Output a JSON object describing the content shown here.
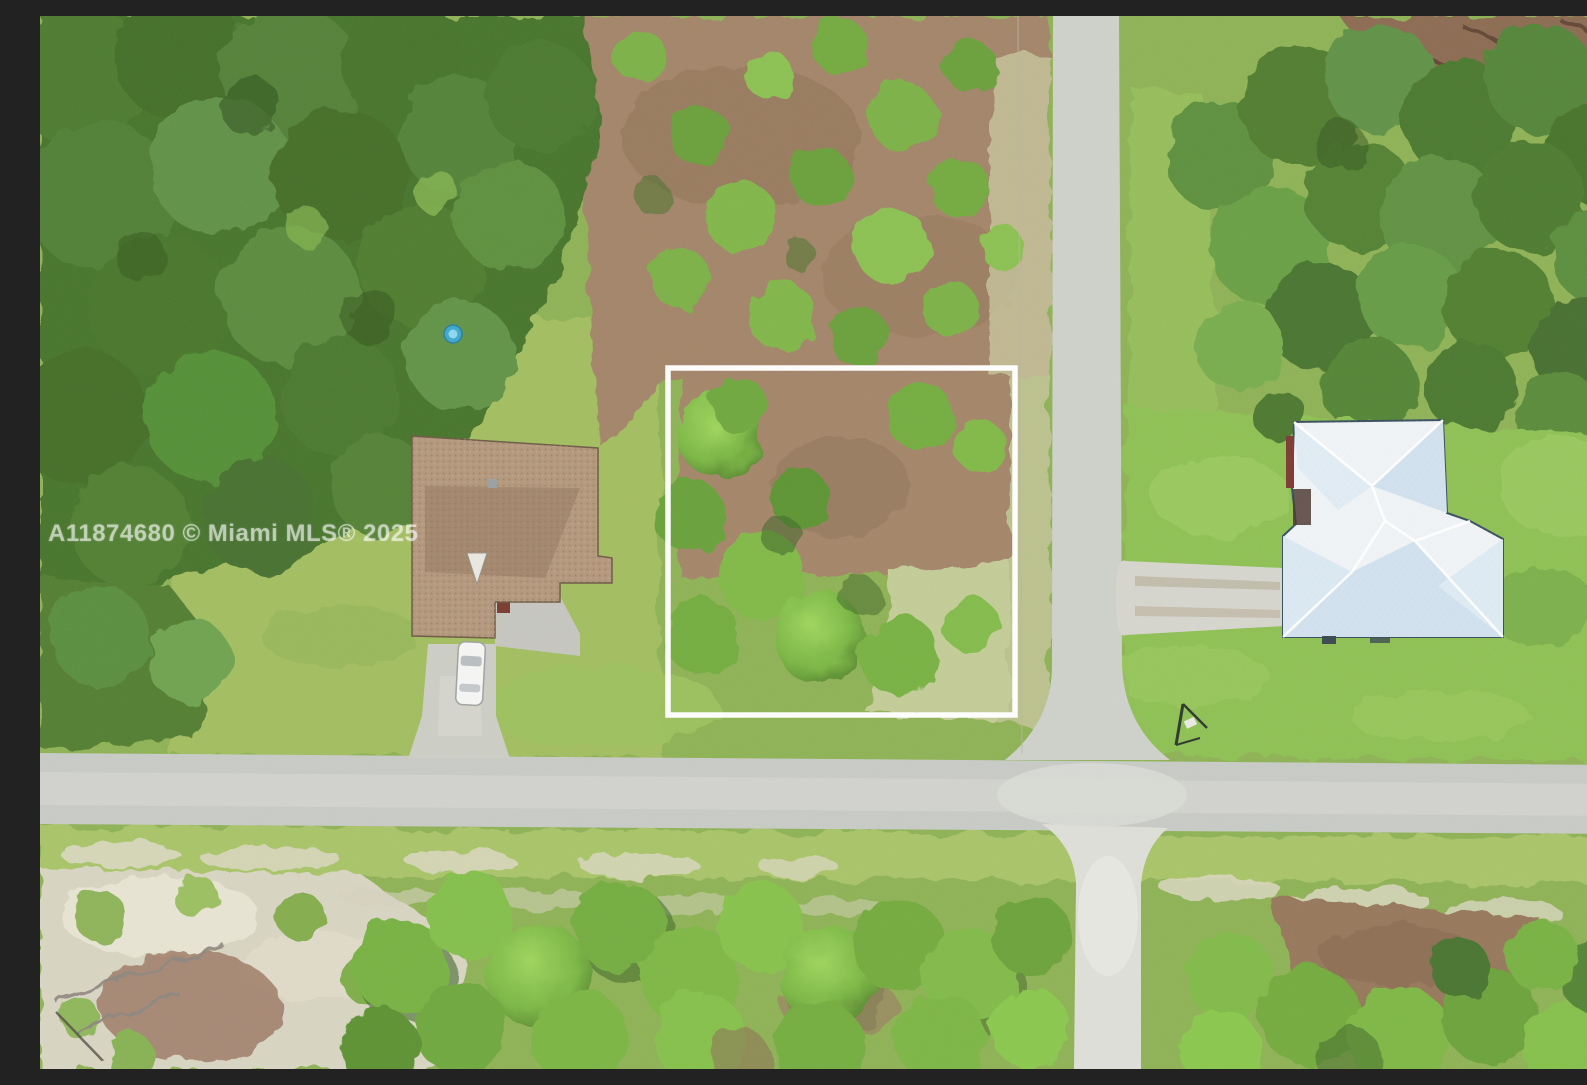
{
  "photo": {
    "watermark": "A11874680 © Miami MLS® 2025"
  },
  "colors": {
    "grass_base": "#8fb257",
    "forest_dark": "#4a762f",
    "canopy_bright": "#7cb746",
    "dirt_brown": "#a3866a",
    "sand_light": "#d8d4c2",
    "road_gray": "#c8cac5",
    "road_lower": "#dcded7",
    "driveway_concrete": "#cccdc5",
    "left_roof_brown": "#b2977c",
    "right_roof_white": "#eef2f4",
    "right_roof_shade": "#cfdfec",
    "pool_blue": "#3fa8cc",
    "car_white": "#f4f4f2",
    "boundary_white": "#ffffff"
  }
}
